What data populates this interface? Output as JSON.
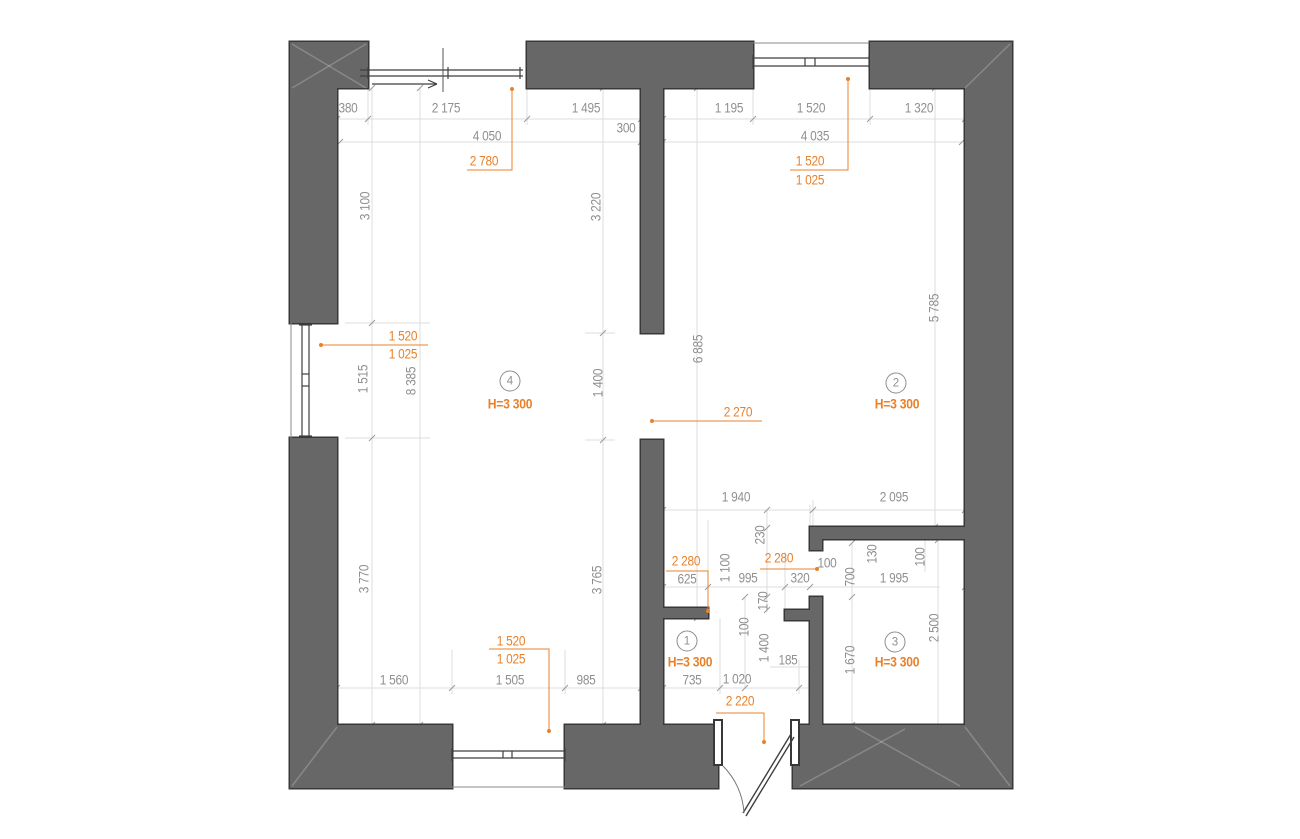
{
  "colors": {
    "wall_fill": "#676767",
    "wall_stroke": "#383838",
    "dim_text": "#8f8f8f",
    "accent": "#e8812a",
    "guide_line": "#dcdcdc",
    "fixture": "#3f3f3f"
  },
  "plan": {
    "width": 1300,
    "height": 839,
    "walls": [
      {
        "name": "top-wall-left",
        "r": [
          290,
          42,
          78,
          46
        ]
      },
      {
        "name": "top-wall-mid",
        "r": [
          527,
          42,
          226,
          46
        ]
      },
      {
        "name": "top-wall-right",
        "r": [
          870,
          42,
          142,
          46
        ]
      },
      {
        "name": "left-wall-upper",
        "r": [
          290,
          42,
          47,
          281
        ]
      },
      {
        "name": "left-wall-lower",
        "r": [
          290,
          438,
          47,
          350
        ]
      },
      {
        "name": "right-wall",
        "r": [
          965,
          42,
          47,
          746
        ]
      },
      {
        "name": "bottom-wall-left",
        "r": [
          290,
          725,
          162,
          63
        ]
      },
      {
        "name": "bottom-wall-mid",
        "r": [
          565,
          725,
          153,
          63
        ]
      },
      {
        "name": "bottom-wall-right",
        "r": [
          793,
          725,
          219,
          63
        ]
      },
      {
        "name": "central-wall-upper",
        "r": [
          641,
          88,
          22,
          245
        ]
      },
      {
        "name": "central-wall-lower",
        "r": [
          641,
          440,
          22,
          285
        ]
      },
      {
        "name": "hall-wall-stub",
        "r": [
          663,
          608,
          45,
          10
        ]
      },
      {
        "name": "room3-left-wall",
        "r": [
          810,
          597,
          12,
          128
        ]
      },
      {
        "name": "room3-left-stub",
        "r": [
          785,
          610,
          25,
          10
        ]
      },
      {
        "name": "room3-top-wall",
        "r": [
          810,
          527,
          155,
          12
        ]
      },
      {
        "name": "room3-top-leg",
        "r": [
          810,
          527,
          12,
          23
        ]
      }
    ],
    "corner_diagonals": [
      [
        292,
        44,
        366,
        88
      ],
      [
        366,
        44,
        292,
        88
      ],
      [
        1010,
        44,
        965,
        88
      ],
      [
        292,
        786,
        337,
        727
      ],
      [
        965,
        727,
        1010,
        786
      ],
      [
        800,
        786,
        905,
        729
      ],
      [
        855,
        727,
        960,
        786
      ]
    ],
    "guide_lines": [
      [
        372,
        88,
        372,
        725
      ],
      [
        420,
        88,
        420,
        725
      ],
      [
        603,
        88,
        603,
        725
      ],
      [
        697,
        88,
        697,
        618
      ],
      [
        935,
        88,
        935,
        527
      ],
      [
        337,
        95,
        337,
        125
      ],
      [
        368,
        62,
        368,
        125
      ],
      [
        527,
        62,
        527,
        125
      ],
      [
        641,
        95,
        641,
        148
      ],
      [
        663,
        95,
        663,
        125
      ],
      [
        753,
        62,
        753,
        125
      ],
      [
        870,
        62,
        870,
        125
      ],
      [
        965,
        95,
        965,
        125
      ],
      [
        337,
        119,
        641,
        119
      ],
      [
        663,
        119,
        965,
        119
      ],
      [
        340,
        142,
        962,
        142
      ],
      [
        345,
        323,
        430,
        323
      ],
      [
        345,
        438,
        430,
        438
      ],
      [
        585,
        333,
        615,
        333
      ],
      [
        585,
        440,
        615,
        440
      ],
      [
        663,
        510,
        965,
        510
      ],
      [
        663,
        587,
        940,
        587
      ],
      [
        663,
        500,
        663,
        520
      ],
      [
        813,
        500,
        813,
        545
      ],
      [
        965,
        500,
        965,
        520
      ],
      [
        708,
        520,
        708,
        592
      ],
      [
        785,
        552,
        785,
        612
      ],
      [
        810,
        505,
        810,
        527
      ],
      [
        767,
        510,
        767,
        612
      ],
      [
        745,
        597,
        745,
        688
      ],
      [
        852,
        543,
        852,
        725
      ],
      [
        938,
        540,
        938,
        733
      ],
      [
        925,
        540,
        925,
        572
      ],
      [
        770,
        667,
        812,
        667
      ],
      [
        337,
        688,
        641,
        688
      ],
      [
        663,
        688,
        810,
        688
      ],
      [
        337,
        660,
        337,
        694
      ],
      [
        452,
        650,
        452,
        694
      ],
      [
        565,
        650,
        565,
        694
      ],
      [
        641,
        660,
        641,
        694
      ],
      [
        663,
        660,
        663,
        694
      ],
      [
        720,
        618,
        720,
        694
      ],
      [
        799,
        660,
        799,
        694
      ]
    ],
    "ticks": [
      [
        337,
        119
      ],
      [
        368,
        119
      ],
      [
        527,
        119
      ],
      [
        641,
        119
      ],
      [
        663,
        119
      ],
      [
        753,
        119
      ],
      [
        870,
        119
      ],
      [
        965,
        119
      ],
      [
        340,
        142
      ],
      [
        641,
        142
      ],
      [
        663,
        142
      ],
      [
        962,
        142
      ],
      [
        372,
        88
      ],
      [
        372,
        323
      ],
      [
        372,
        438
      ],
      [
        372,
        725
      ],
      [
        420,
        88
      ],
      [
        420,
        725
      ],
      [
        603,
        88
      ],
      [
        603,
        333
      ],
      [
        603,
        440
      ],
      [
        603,
        725
      ],
      [
        697,
        88
      ],
      [
        697,
        618
      ],
      [
        935,
        88
      ],
      [
        935,
        527
      ],
      [
        663,
        510
      ],
      [
        813,
        510
      ],
      [
        965,
        510
      ],
      [
        663,
        587
      ],
      [
        708,
        587
      ],
      [
        785,
        587
      ],
      [
        810,
        587
      ],
      [
        965,
        587
      ],
      [
        337,
        688
      ],
      [
        452,
        688
      ],
      [
        565,
        688
      ],
      [
        641,
        688
      ],
      [
        663,
        688
      ],
      [
        720,
        688
      ],
      [
        799,
        688
      ],
      [
        767,
        510
      ],
      [
        767,
        528
      ],
      [
        767,
        597
      ],
      [
        767,
        610
      ],
      [
        852,
        543
      ],
      [
        852,
        597
      ],
      [
        852,
        725
      ],
      [
        938,
        540
      ],
      [
        938,
        733
      ],
      [
        745,
        597
      ],
      [
        745,
        688
      ]
    ],
    "fixtures": {
      "sliding_door": {
        "rails": [
          [
            360,
            70,
            523,
            70
          ],
          [
            360,
            76,
            523,
            76
          ]
        ],
        "caps": [
          [
            368,
            67,
            368,
            79
          ],
          [
            448,
            67,
            448,
            79
          ],
          [
            520,
            67,
            520,
            79
          ]
        ],
        "centerline": [
          443,
          48,
          443,
          92
        ],
        "arrow_shaft": [
          372,
          84,
          436,
          84
        ],
        "arrow_head": [
          [
            428,
            80,
            437,
            84
          ],
          [
            428,
            88,
            437,
            84
          ]
        ]
      },
      "windows": [
        {
          "name": "window-top",
          "rails": [
            [
              753,
              58,
              869,
              58
            ],
            [
              753,
              66,
              869,
              66
            ]
          ],
          "caps": [
            [
              753,
              55,
              753,
              69
            ],
            [
              869,
              55,
              869,
              69
            ],
            [
              805,
              58,
              805,
              66
            ],
            [
              815,
              58,
              815,
              66
            ]
          ],
          "outer": [
            753,
            43,
            869,
            43
          ]
        },
        {
          "name": "window-left",
          "rails": [
            [
              302,
              325,
              302,
              436
            ],
            [
              309,
              325,
              309,
              436
            ]
          ],
          "caps": [
            [
              299,
              325,
              312,
              325
            ],
            [
              299,
              436,
              312,
              436
            ],
            [
              302,
              374,
              309,
              374
            ],
            [
              302,
              386,
              309,
              386
            ]
          ],
          "outer": [
            291,
            323,
            291,
            438
          ]
        },
        {
          "name": "window-bottom",
          "rails": [
            [
              452,
              751,
              565,
              751
            ],
            [
              452,
              758,
              565,
              758
            ]
          ],
          "caps": [
            [
              452,
              748,
              452,
              761
            ],
            [
              565,
              748,
              565,
              761
            ],
            [
              503,
              751,
              503,
              758
            ],
            [
              512,
              751,
              512,
              758
            ]
          ],
          "outer": [
            452,
            787,
            565,
            787
          ]
        }
      ],
      "entrance_door": {
        "jambs": [
          [
            714,
            720,
            8,
            45
          ],
          [
            791,
            720,
            8,
            45
          ]
        ],
        "leaf": [
          [
            791,
            734,
            743,
            813
          ],
          [
            794,
            737,
            746,
            816
          ]
        ],
        "arc": "M 723 766 A 72 72 0 0 1 744 813"
      }
    },
    "leaders": [
      {
        "pts": [
          [
            467,
            170
          ],
          [
            512,
            170
          ],
          [
            512,
            89
          ]
        ],
        "dot": [
          512,
          89
        ]
      },
      {
        "pts": [
          [
            790,
            170
          ],
          [
            848,
            170
          ],
          [
            848,
            79
          ]
        ],
        "dot": [
          848,
          79
        ]
      },
      {
        "pts": [
          [
            428,
            345
          ],
          [
            321,
            345
          ]
        ],
        "dot": [
          321,
          345
        ]
      },
      {
        "pts": [
          [
            762,
            421
          ],
          [
            652,
            421
          ]
        ],
        "dot": [
          652,
          421
        ]
      },
      {
        "pts": [
          [
            666,
            571
          ],
          [
            708,
            571
          ],
          [
            708,
            610
          ]
        ],
        "dot": [
          708,
          611
        ]
      },
      {
        "pts": [
          [
            760,
            569
          ],
          [
            816,
            569
          ]
        ],
        "dot": [
          817,
          569
        ]
      },
      {
        "pts": [
          [
            716,
            713
          ],
          [
            764,
            713
          ],
          [
            764,
            740
          ]
        ],
        "dot": [
          764,
          742
        ]
      },
      {
        "pts": [
          [
            489,
            649
          ],
          [
            549,
            649
          ],
          [
            549,
            729
          ]
        ],
        "dot": [
          549,
          731
        ]
      }
    ]
  },
  "labels": {
    "dims": [
      {
        "t": "380",
        "x": 348,
        "y": 108
      },
      {
        "t": "2 175",
        "x": 446,
        "y": 108
      },
      {
        "t": "1 495",
        "x": 586,
        "y": 108
      },
      {
        "t": "300",
        "x": 626,
        "y": 128
      },
      {
        "t": "4 050",
        "x": 487,
        "y": 136
      },
      {
        "t": "1 195",
        "x": 729,
        "y": 108
      },
      {
        "t": "1 520",
        "x": 811,
        "y": 108
      },
      {
        "t": "1 320",
        "x": 919,
        "y": 108
      },
      {
        "t": "4 035",
        "x": 815,
        "y": 136
      },
      {
        "t": "3 100",
        "x": 365,
        "y": 206,
        "r": 1
      },
      {
        "t": "1 515",
        "x": 363,
        "y": 379,
        "r": 1
      },
      {
        "t": "3 770",
        "x": 364,
        "y": 579,
        "r": 1
      },
      {
        "t": "8 385",
        "x": 411,
        "y": 381,
        "r": 1
      },
      {
        "t": "3 220",
        "x": 596,
        "y": 207,
        "r": 1
      },
      {
        "t": "1 400",
        "x": 598,
        "y": 383,
        "r": 1
      },
      {
        "t": "3 765",
        "x": 597,
        "y": 580,
        "r": 1
      },
      {
        "t": "6 885",
        "x": 698,
        "y": 349,
        "r": 1
      },
      {
        "t": "5 785",
        "x": 934,
        "y": 308,
        "r": 1
      },
      {
        "t": "1 940",
        "x": 736,
        "y": 497
      },
      {
        "t": "2 095",
        "x": 894,
        "y": 497
      },
      {
        "t": "230",
        "x": 760,
        "y": 535,
        "r": 1
      },
      {
        "t": "1 100",
        "x": 725,
        "y": 568,
        "r": 1
      },
      {
        "t": "625",
        "x": 687,
        "y": 579
      },
      {
        "t": "995",
        "x": 748,
        "y": 578
      },
      {
        "t": "320",
        "x": 800,
        "y": 578
      },
      {
        "t": "100",
        "x": 827,
        "y": 563
      },
      {
        "t": "700",
        "x": 850,
        "y": 577,
        "r": 1
      },
      {
        "t": "130",
        "x": 872,
        "y": 554,
        "r": 1
      },
      {
        "t": "100",
        "x": 920,
        "y": 557,
        "r": 1
      },
      {
        "t": "1 995",
        "x": 894,
        "y": 578
      },
      {
        "t": "170",
        "x": 763,
        "y": 601,
        "r": 1
      },
      {
        "t": "100",
        "x": 744,
        "y": 627,
        "r": 1
      },
      {
        "t": "1 400",
        "x": 764,
        "y": 648,
        "r": 1
      },
      {
        "t": "185",
        "x": 788,
        "y": 660
      },
      {
        "t": "1 670",
        "x": 850,
        "y": 660,
        "r": 1
      },
      {
        "t": "2 500",
        "x": 934,
        "y": 628,
        "r": 1
      },
      {
        "t": "735",
        "x": 692,
        "y": 680
      },
      {
        "t": "1 020",
        "x": 737,
        "y": 679
      },
      {
        "t": "1 560",
        "x": 394,
        "y": 680
      },
      {
        "t": "1 505",
        "x": 510,
        "y": 680
      },
      {
        "t": "985",
        "x": 586,
        "y": 680
      }
    ],
    "accent_dims": [
      {
        "t": "2 780",
        "x": 484,
        "y": 161
      },
      {
        "t": "1 520",
        "x": 810,
        "y": 161
      },
      {
        "t": "1 025",
        "x": 810,
        "y": 180
      },
      {
        "t": "1 520",
        "x": 403,
        "y": 336
      },
      {
        "t": "1 025",
        "x": 403,
        "y": 354
      },
      {
        "t": "2 270",
        "x": 738,
        "y": 412
      },
      {
        "t": "2 280",
        "x": 686,
        "y": 561
      },
      {
        "t": "2 280",
        "x": 779,
        "y": 558
      },
      {
        "t": "2 220",
        "x": 740,
        "y": 701
      },
      {
        "t": "1 520",
        "x": 511,
        "y": 641
      },
      {
        "t": "1 025",
        "x": 511,
        "y": 659
      }
    ],
    "rooms": [
      {
        "num": "4",
        "cx": 510,
        "cy": 381,
        "h": "H=3 300",
        "hx": 510,
        "hy": 404
      },
      {
        "num": "2",
        "cx": 896,
        "cy": 383,
        "h": "H=3 300",
        "hx": 897,
        "hy": 404
      },
      {
        "num": "1",
        "cx": 687,
        "cy": 641,
        "h": "H=3 300",
        "hx": 690,
        "hy": 662
      },
      {
        "num": "3",
        "cx": 895,
        "cy": 642,
        "h": "H=3 300",
        "hx": 897,
        "hy": 662
      }
    ]
  }
}
